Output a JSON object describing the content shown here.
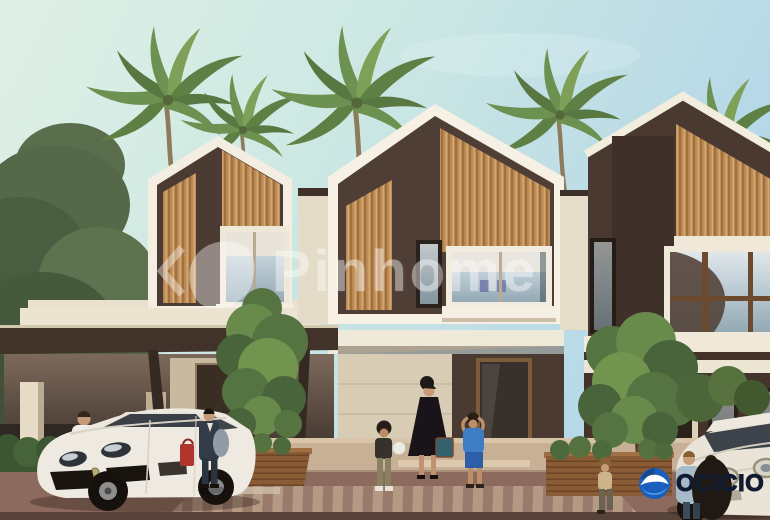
{
  "watermark": {
    "text": "Pinhome",
    "color": "#ffffff"
  },
  "brand": {
    "text": "OCICIO",
    "text_color": "#101a31",
    "icon_color": "#1b5fbe",
    "icon_accent": "#57a7e8"
  },
  "scene": {
    "sky_left": "#dff0e6",
    "sky_right": "#b3d6e8",
    "wall_dark": "#4f3e36",
    "wall_cream": "#f2ecdf",
    "wood_slat": "#bd8c57",
    "foliage": "#5d7a45",
    "paving": "#8c6a5e"
  }
}
